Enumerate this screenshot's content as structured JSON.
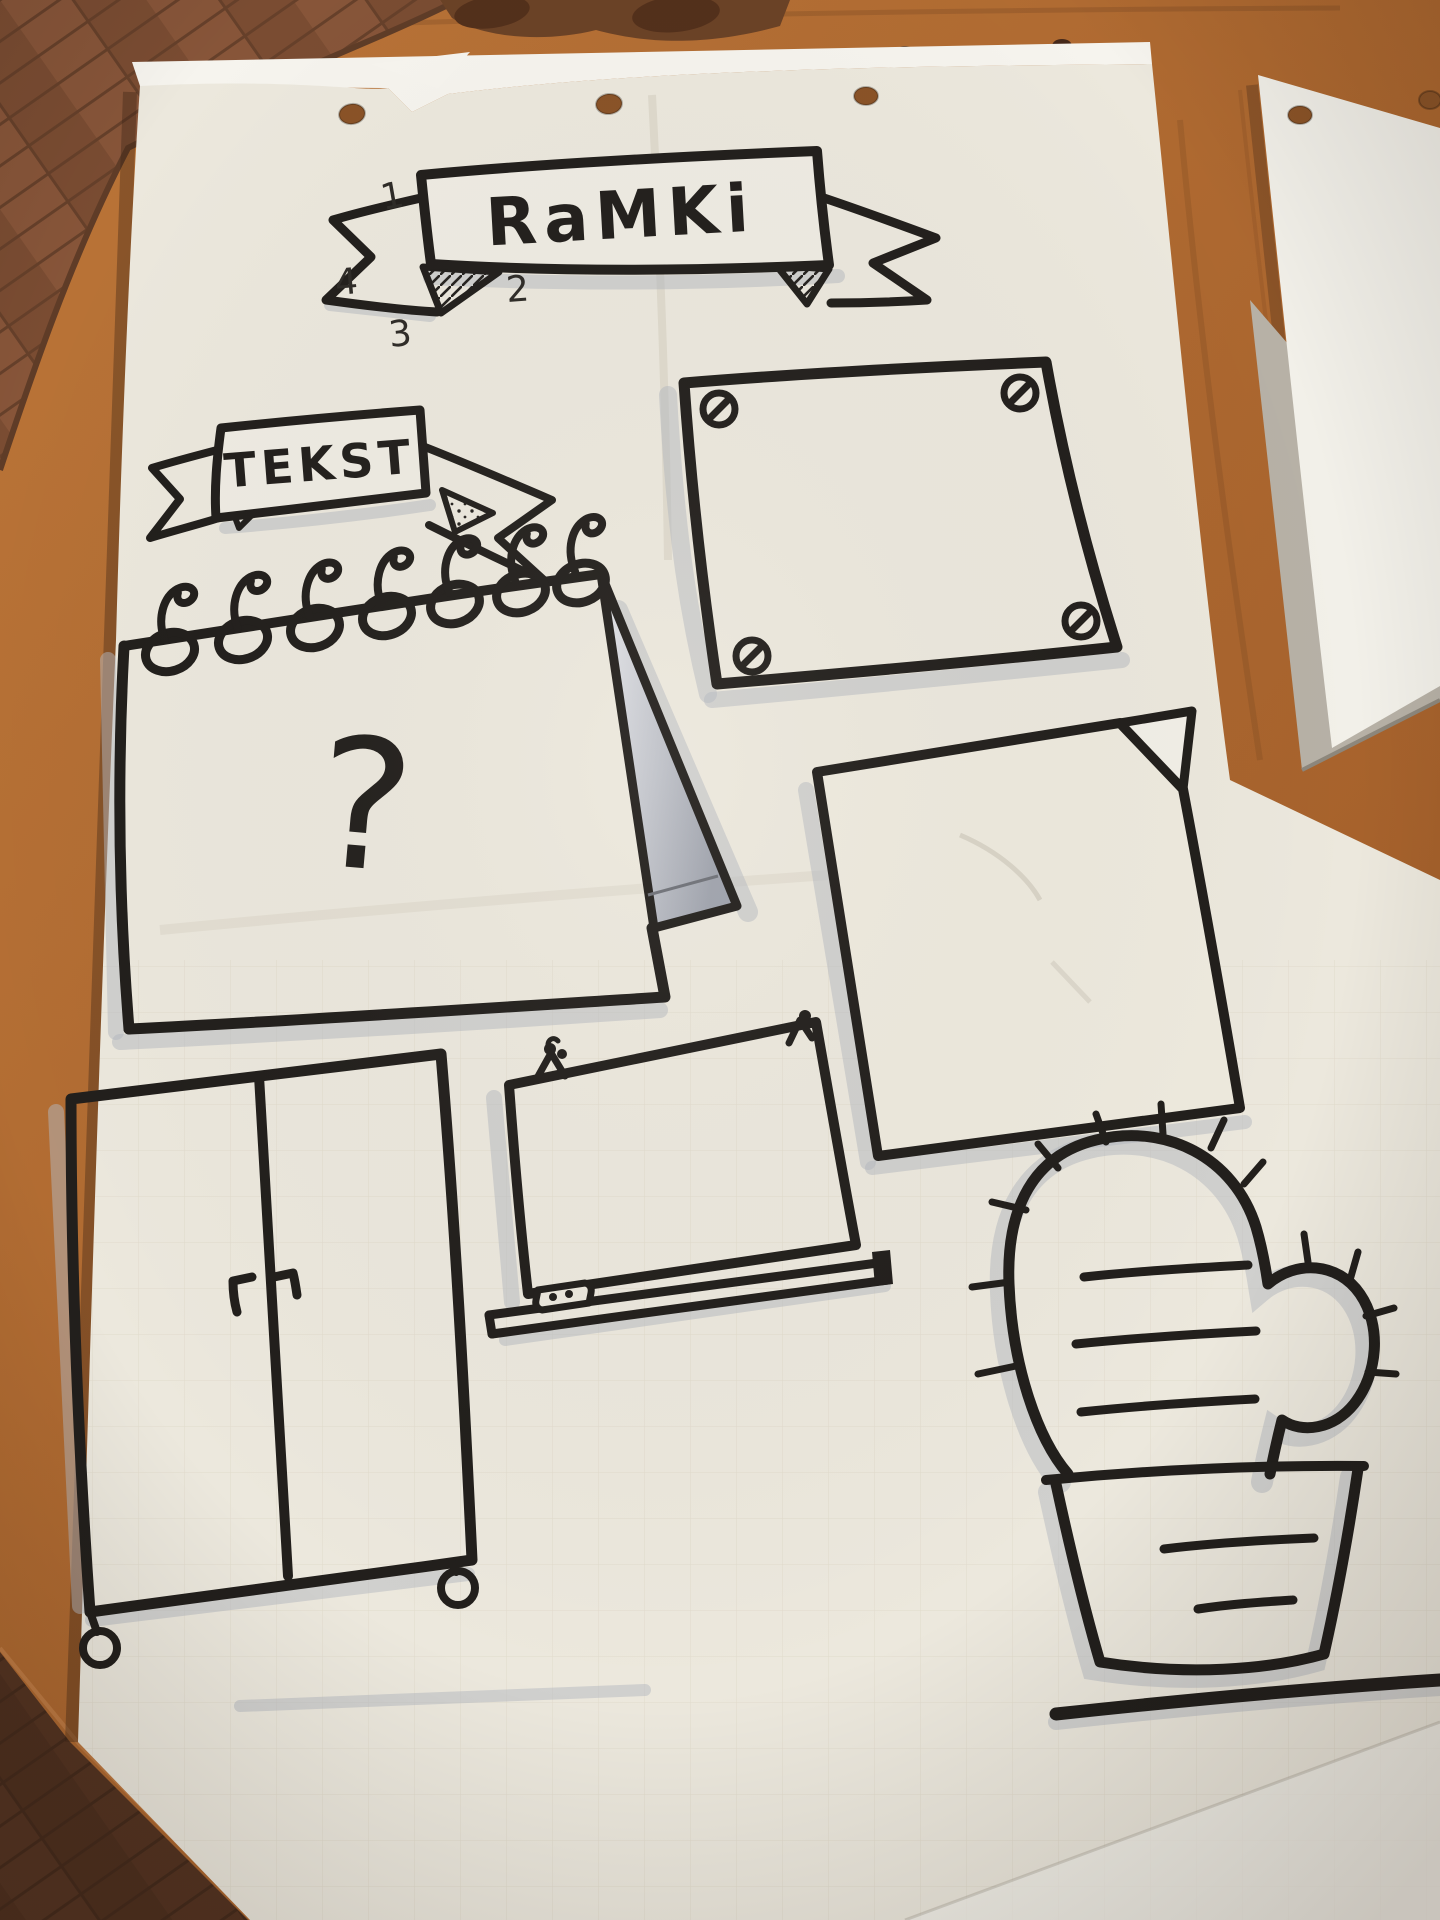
{
  "photo": {
    "drawings": {
      "title_banner": "RaMKi",
      "subtitle_banner": "TEKST",
      "notepad_mark": "?",
      "step_numbers": {
        "n1": "1",
        "n2": "2",
        "n3": "3",
        "n4": "4"
      }
    },
    "colors": {
      "ink": "#221f1c",
      "marker_shadow": "#b3b7c0",
      "paper": "#ece8dd",
      "second_sheet": "#f2f0e9",
      "backing_sheet": "#b7b1a6",
      "table_wood": "#b06a33",
      "floor_wood": "#7f5036",
      "fold_grey": "#c6c8ce"
    }
  }
}
